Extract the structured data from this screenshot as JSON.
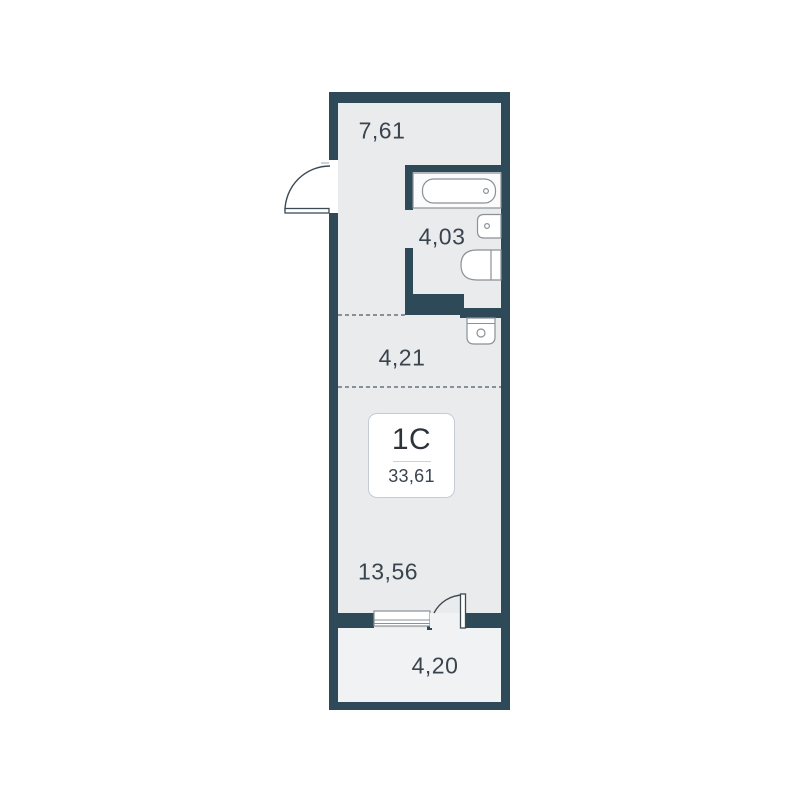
{
  "unit": {
    "type_label": "1C",
    "total_area": "33,61"
  },
  "rooms": [
    {
      "id": "hallway",
      "area": "7,61"
    },
    {
      "id": "bathroom",
      "area": "4,03"
    },
    {
      "id": "corridor",
      "area": "4,21"
    },
    {
      "id": "living-room",
      "area": "13,56"
    },
    {
      "id": "balcony",
      "area": "4,20"
    }
  ],
  "fixtures": [
    "bathtub",
    "sink",
    "toilet",
    "washing-machine",
    "entry-door",
    "balcony-door",
    "window"
  ],
  "colors": {
    "wall": "#2e4a58",
    "floor": "#eaebed",
    "balcony_floor": "#f1f2f3",
    "outline": "#8a9198",
    "text": "#3a444e",
    "dash": "#66727c",
    "badge_border": "#c7ccd2",
    "background": "#ffffff"
  }
}
